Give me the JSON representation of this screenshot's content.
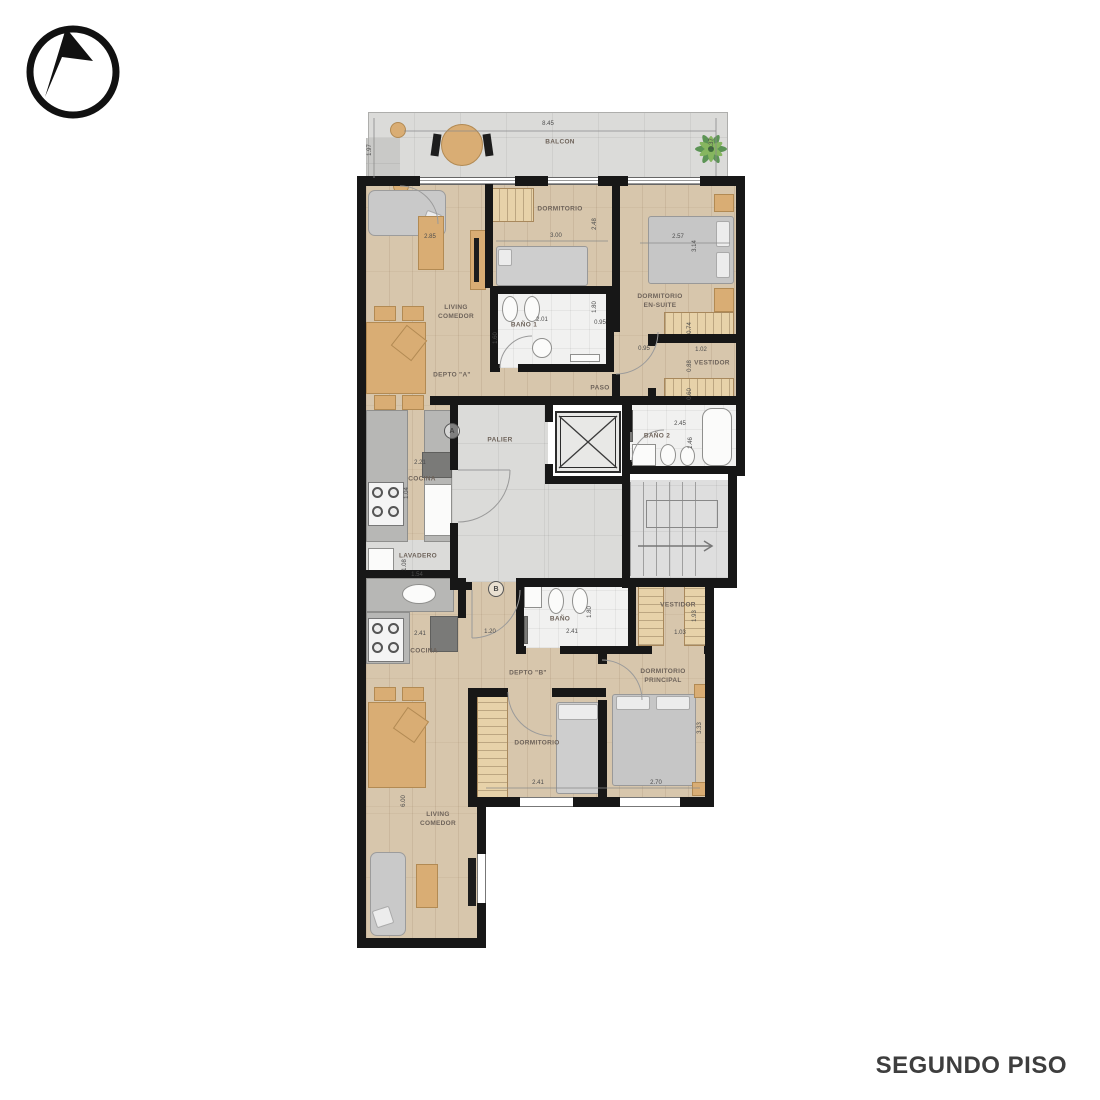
{
  "footer": {
    "title": "SEGUNDO PISO"
  },
  "plan": {
    "markers": {
      "a": "A",
      "b": "B"
    },
    "balcony": {
      "label": "BALCON",
      "w": "8.45",
      "left": "1.97",
      "right": "1.37"
    },
    "palier": {
      "label": "PALIER"
    },
    "depto_a": {
      "label": "DEPTO \"A\"",
      "living": {
        "label": "LIVING\nCOMEDOR",
        "w": "2.85"
      },
      "dormitorio": {
        "label": "DORMITORIO",
        "w": "3.00",
        "h": "2.48",
        "h2": "1.80"
      },
      "bano1": {
        "label": "BAÑO 1",
        "w": "2.01",
        "h": "1.60"
      },
      "paso": {
        "label": "PASO",
        "opening": "0.95",
        "opening2": "0.95"
      },
      "en_suite": {
        "label": "DORMITORIO\nEN-SUITE",
        "w": "2.57",
        "h": "3.14",
        "closet": "0.74",
        "pass": "1.02"
      },
      "vestidor": {
        "label": "VESTIDOR",
        "h1": "0.88",
        "h2": "0.60"
      },
      "cocina": {
        "label": "COCINA",
        "w": "2.21",
        "h": "1.04"
      },
      "lavadero": {
        "label": "LAVADERO",
        "h": "1.08",
        "w": "1.54"
      },
      "bano2": {
        "label": "BAÑO 2",
        "w": "2.45",
        "h": "1.46"
      }
    },
    "depto_b": {
      "label": "DEPTO \"B\"",
      "cocina": {
        "label": "COCINA",
        "w": "2.41"
      },
      "hall": {
        "w": "1.20"
      },
      "bano": {
        "label": "BAÑO",
        "w": "2.41",
        "h": "1.80"
      },
      "vestidor": {
        "label": "VESTIDOR",
        "w": "1.03",
        "h": "1.93"
      },
      "principal": {
        "label": "DORMITORIO\nPRINCIPAL",
        "w": "2.70",
        "h": "3.33"
      },
      "dormitorio": {
        "label": "DORMITORIO",
        "w": "2.41"
      },
      "living": {
        "label": "LIVING\nCOMEDOR",
        "h": "6.00"
      }
    }
  }
}
